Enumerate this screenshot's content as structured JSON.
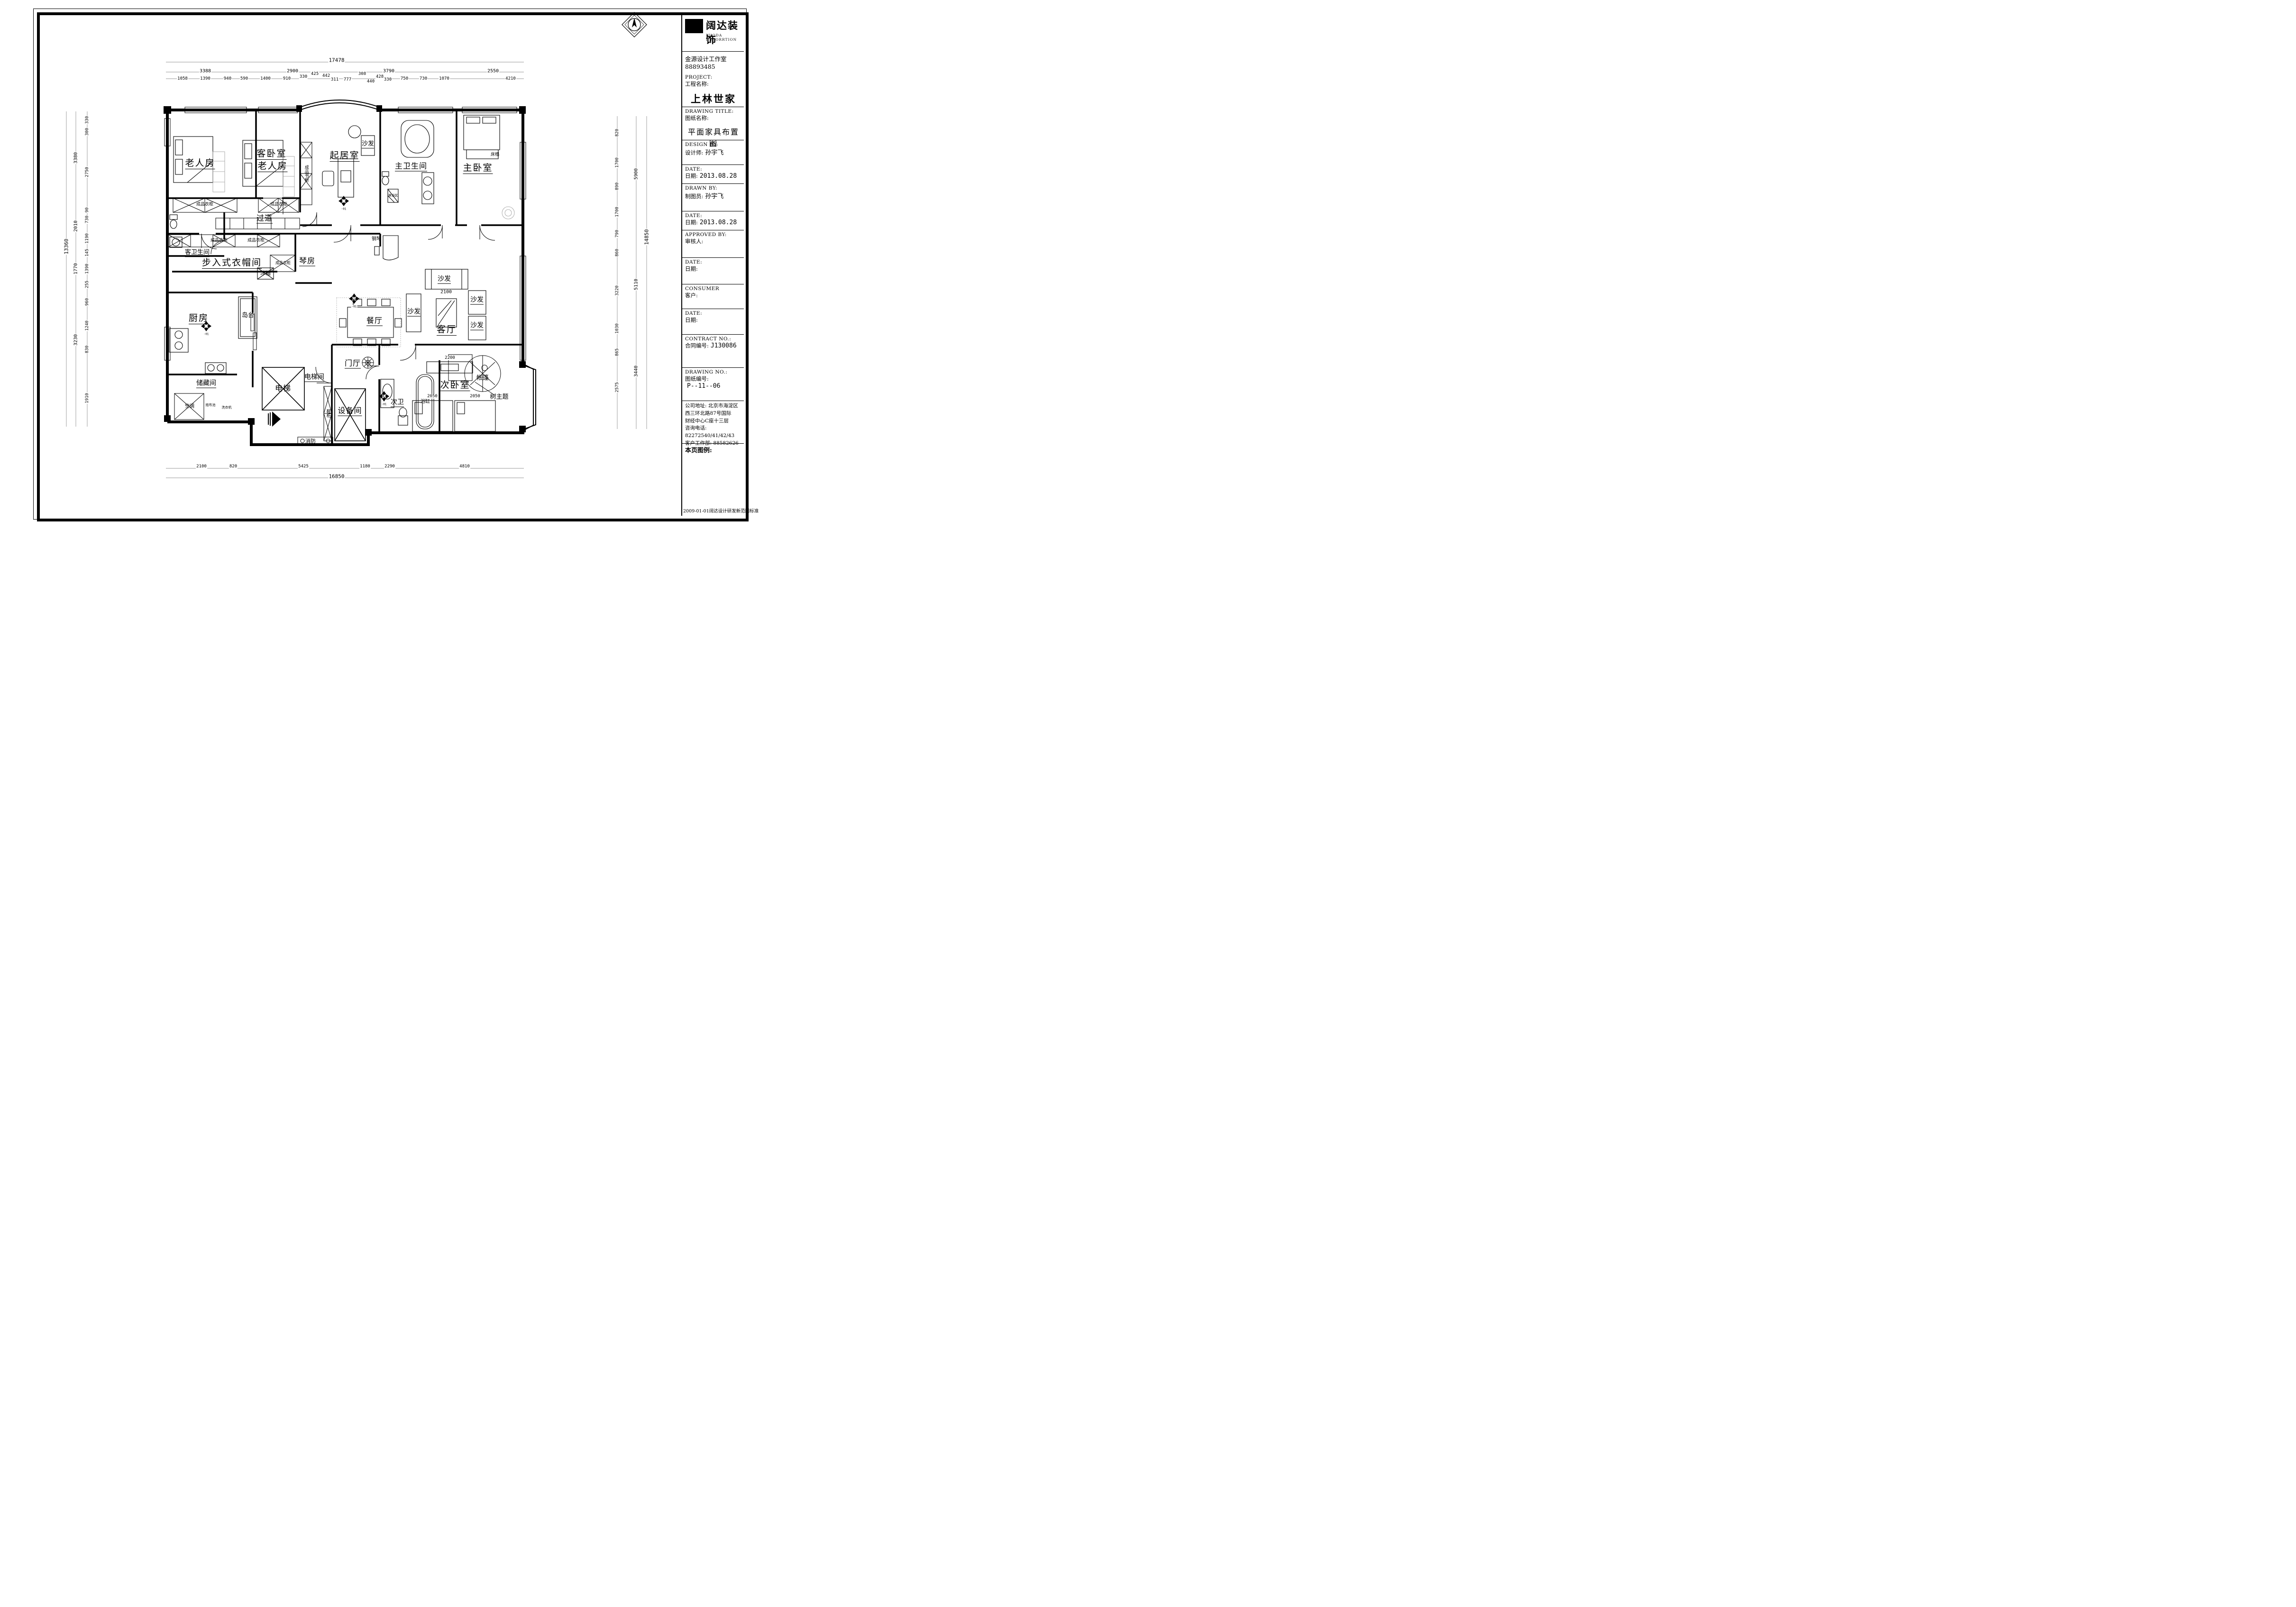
{
  "title_block": {
    "logo_text": "阔达装饰",
    "logo_sub": "KUODA DECORRTION",
    "studio": "金源设计工作室",
    "studio_phone": "88893485",
    "project_en": "PROJECT:",
    "project_zh": "工程名称:",
    "project_value": "上林世家",
    "drawing_title_en": "DRAWING TITLE:",
    "drawing_title_zh": "图纸名称:",
    "drawing_title_value": "平面家具布置图",
    "design_by_en": "DESIGN BY:",
    "design_by_zh": "设计师:",
    "design_by_value": "孙宇飞",
    "date1_en": "DATE:",
    "date1_zh": "日期:",
    "date1_value": "2013.08.28",
    "drawn_by_en": "DRAWN BY:",
    "drawn_by_zh": "制图员:",
    "drawn_by_value": "孙宇飞",
    "date2_en": "DATE:",
    "date2_zh": "日期:",
    "date2_value": "2013.08.28",
    "approved_en": "APPROVED BY:",
    "approved_zh": "审核人:",
    "date3_en": "DATE:",
    "date3_zh": "日期:",
    "consumer_en": "CONSUMER",
    "consumer_zh": "客户:",
    "date4_en": "DATE:",
    "date4_zh": "日期:",
    "contract_en": "CONTRACT NO.:",
    "contract_zh": "合同编号:",
    "contract_value": "J130086",
    "drawing_no_en": "DRAWING NO.:",
    "drawing_no_zh": "图纸编号:",
    "drawing_no_value": "P--11--06",
    "address_label": "公司地址:",
    "address_value": "北京市海淀区西三环北路87号国际",
    "address_value2": "财经中心C座十三层",
    "phone_label": "咨询电话:",
    "phone_value": "82272540/41/42/43",
    "service_label": "客户工作部:",
    "service_value": "88582626",
    "legend_label": "本页图例:",
    "footer_note": "2009-01-01阔达设计研发新范图标准"
  },
  "rooms": {
    "elderly1": "老人房",
    "guest_bed_title": "客卧室",
    "guest_bed_sub": "老人房",
    "family_room": "起居室",
    "sofa": "沙发",
    "master_bath": "主卫生间",
    "master_bedroom": "主卧室",
    "bed_bench": "床榻",
    "corridor": "过道",
    "guest_bath": "客卫生间",
    "closet": "步入式衣帽间",
    "piano_room": "琴房",
    "piano": "钢琴",
    "fridge": "冰箱",
    "kitchen": "厨房",
    "island": "岛台",
    "dining": "餐厅",
    "living": "客厅",
    "storage": "储藏间",
    "ac": "空调",
    "mop_sink": "拖布池",
    "washer": "洗衣机",
    "elevator": "电梯",
    "elevator_hall": "电梯间",
    "shoe_cabinet": "鞋柜",
    "equipment": "设备间",
    "foyer": "门厅",
    "second_bath": "次卫",
    "bathtub": "浴缸",
    "fire": "消防",
    "second_bedroom": "次卧室",
    "tent": "帐篷",
    "tree_theme": "树主题",
    "wardrobe": "成品衣柜",
    "bookcase": "成品书柜",
    "shower": "淋浴区"
  },
  "dims": {
    "top_total": "17478",
    "top_l2": [
      "3388",
      "2900",
      "3790",
      "2550"
    ],
    "top_l3": [
      "1058",
      "1390",
      "940",
      "590",
      "1400",
      "910",
      "330",
      "425",
      "442",
      "311",
      "777",
      "308",
      "440",
      "428",
      "330",
      "750",
      "730",
      "1070",
      "4210"
    ],
    "bottom_l1": [
      "2100",
      "820",
      "5425",
      "1180",
      "2290",
      "4810"
    ],
    "bottom_total": "16850",
    "left_total": "13360",
    "left_l2": [
      "3380",
      "2010",
      "1770",
      "3230"
    ],
    "left_l3": [
      "330",
      "300",
      "2750",
      "90",
      "730",
      "1190",
      "145",
      "1390",
      "255",
      "960",
      "1240",
      "830",
      "1910"
    ],
    "right_total": "14850",
    "right_l2": [
      "5900",
      "5110",
      "3440"
    ],
    "right_l3": [
      "820",
      "1700",
      "890",
      "1700",
      "790",
      "860",
      "3220",
      "1030",
      "865",
      "2575"
    ],
    "furn": {
      "sofa": "2100",
      "tv": "2200",
      "bed_a": "2050",
      "bed_b": "2050"
    }
  },
  "markers": {
    "suffix": "-01"
  }
}
